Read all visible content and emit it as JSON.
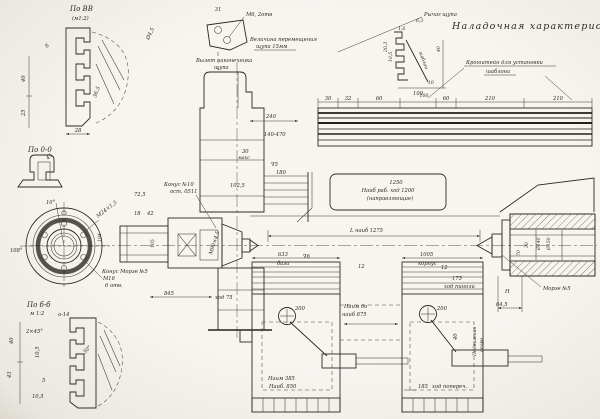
{
  "title": "Наладочная характеристика",
  "sections": {
    "vv": {
      "name": "По ВВ",
      "scale": "(м1:2)",
      "d28": "28",
      "d25": "25",
      "d40": "40",
      "d365": "36,5",
      "d8": "8"
    },
    "oo": {
      "name": "По 0-0",
      "d45": "45"
    },
    "flange": {
      "a10": "10°",
      "thread": "М24×1,5",
      "a108": "108°",
      "holes": "М16",
      "holes2": "6 отв."
    },
    "bb": {
      "name": "По б-б",
      "scale": "м 1:2",
      "a14": "а-14",
      "ch": "2×45°",
      "d40": "40",
      "d43": "43",
      "d105": "10,5",
      "d5": "5",
      "a30": "30°",
      "d105b": "10,5"
    }
  },
  "probe": {
    "holes": "М6, 2отв",
    "move1": "Величина перемещения",
    "move2": "щупа 15мм",
    "tip1": "Вылет наконечника",
    "tip2": "щупа",
    "lever": "Рычаг щупа",
    "d31": "31",
    "d45": "Ø4,5"
  },
  "bracket": {
    "line1": "Кронштейн для установки",
    "line2": "шаблона"
  },
  "detail": {
    "d63": "6,3",
    "d16": "1,6",
    "d203": "20,3",
    "d105": "10,5",
    "word": "шаблон",
    "d40": "40",
    "d10": "10",
    "d100": "100"
  },
  "rail": {
    "dims": [
      "30",
      "32",
      "60",
      "100",
      "60",
      "210",
      "210"
    ]
  },
  "headstock": {
    "cone1": "Конус №10",
    "cone2": "ост. 0511",
    "d725": "72,5",
    "d18": "18",
    "d42": "42",
    "d1025": "102,5",
    "d240": "240",
    "range": "140-470",
    "d30": "30",
    "dmax": "макс",
    "fin": "∇5",
    "f180": "180",
    "morse": "Конус Морзе №5",
    "d845": "845",
    "stroke": "ход 75",
    "thread": "М90×4,5",
    "d104": "104",
    "d105": "105"
  },
  "bed": {
    "l1": "1250",
    "l2": "Наиб раб. ход 1200",
    "l3": "(направляющие)",
    "lmax": "L наиб 1275"
  },
  "pedestals": {
    "lt1": "633",
    "lt2": "база",
    "rt1": "1005",
    "rt2": "корпус",
    "c1": "200",
    "c2": "200",
    "mid1": "Наим до",
    "mid2": "наиб 875",
    "lo1": "Наим 385",
    "lo2": "Наиб. 850",
    "d12a": "12",
    "d12b": "12",
    "cross1": "185",
    "cross2": "ход попереч.",
    "d40": "40",
    "v1": "Подвижная",
    "v2": "опора",
    "fin": "∇6"
  },
  "tailstock": {
    "q1": "175",
    "q2": "ход пиноли",
    "d70": "70",
    "d30": "30",
    "d140": "Ø140",
    "d150": "Ø150",
    "morse": "Морзе №5",
    "h": "Н",
    "d645": "64,5"
  }
}
